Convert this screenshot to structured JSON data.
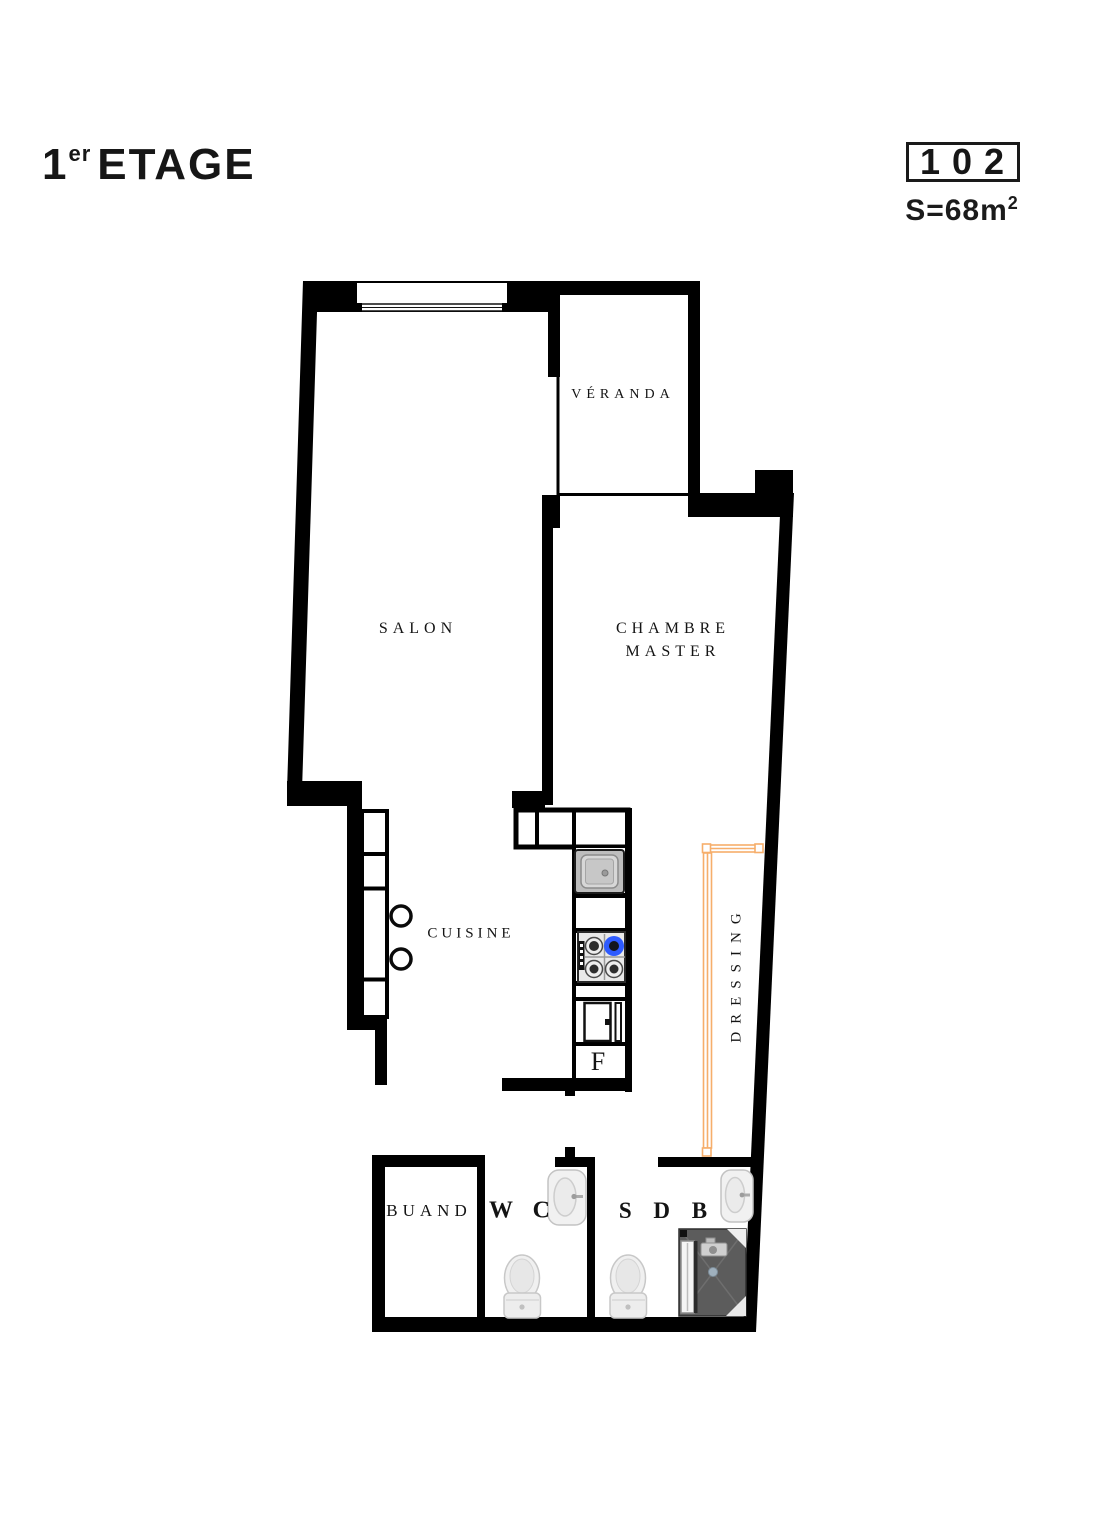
{
  "header": {
    "floor_number": "1",
    "floor_suffix": "er",
    "floor_word": "ETAGE",
    "unit_number": "102",
    "area_text": "S=68m",
    "area_exponent": "2"
  },
  "rooms": {
    "veranda": {
      "label": "VÉRANDA"
    },
    "salon": {
      "label": "SALON"
    },
    "chambre_master": {
      "line1": "CHAMBRE",
      "line2": "MASTER"
    },
    "cuisine": {
      "label": "CUISINE"
    },
    "dressing": {
      "label": "DRESSING"
    },
    "buanderie": {
      "label": "BUAND"
    },
    "wc": {
      "label": "W C"
    },
    "sdb": {
      "label": "S D B"
    }
  },
  "fixtures": {
    "fridge_label": "F",
    "kitchen_sink": "sink",
    "stove": "gas-hob-4-burners",
    "wardrobe": "dressing-closet",
    "shower": "shower-cabin",
    "toilets": 2,
    "washbasins": 2
  },
  "colors": {
    "wall": "#000000",
    "wardrobe_accent": "#F6AE6B",
    "stove_flame": "#2E5BFF",
    "background": "#FFFFFF"
  }
}
